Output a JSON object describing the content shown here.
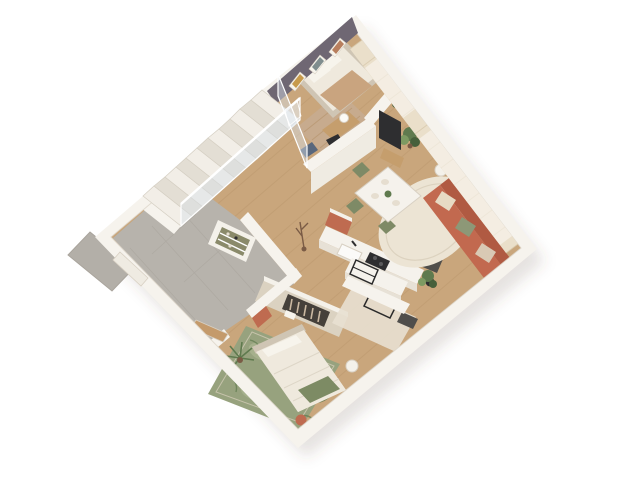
{
  "meta": {
    "description": "Photoreal 3D isometric top-down render of a small duplex apartment floor plan on a plain white background, rotated diamond orientation",
    "canvas": {
      "width": 640,
      "height": 480
    }
  },
  "scene": {
    "type": "3d-floor-plan",
    "view": "isometric top-down, rotated ~40 degrees",
    "floors": {
      "main": "light oak wood",
      "hallway": "grey tile",
      "porch": "grey tile"
    },
    "staircase": {
      "steps": 11,
      "balustrade": "glass",
      "location": "along upper-left exterior wall"
    },
    "rooms": [
      {
        "name": "bedroom-upper",
        "features": [
          "upholstered double bed with white and tan bedding",
          "dark mauve accent wall with three framed artworks",
          "patterned beige rug",
          "navy throw on rug",
          "wooden desk with round white table lamp",
          "black chair",
          "green plant by window",
          "cream curtains"
        ]
      },
      {
        "name": "living-dining",
        "features": [
          "terracotta three-seat sofa with cushions",
          "large round cream rug",
          "white dining table with plates and plant centerpiece",
          "four olive-green chairs",
          "dark TV panel on partition with wooden media console",
          "tall floor plants",
          "sheer white curtains over full-height windows"
        ]
      },
      {
        "name": "kitchen",
        "features": [
          "white counter with sink and black faucet",
          "dark cooktop",
          "terracotta cabinet with white top",
          "black-framed open shelf",
          "island counter",
          "dark floor mat",
          "dark bar stool",
          "branch plant in vase"
        ]
      },
      {
        "name": "nook",
        "features": [
          "black-framed console",
          "small dark mat",
          "light tiled floor"
        ]
      },
      {
        "name": "bedroom-lower",
        "features": [
          "double bed with cream duvet and pillows",
          "green botanical rug",
          "sage green throw",
          "wardrobe with open hanging section and clothes",
          "palm plant",
          "terracotta pouf",
          "round white side table",
          "terracotta accent wall by door",
          "wooden interior door"
        ]
      },
      {
        "name": "hallway-entry",
        "features": [
          "grey tile floor",
          "open shelf unit with olive back panels",
          "staircase with glass balustrade",
          "exterior grey porch pad",
          "entry door"
        ]
      }
    ]
  },
  "colors": {
    "wall": "#f6f3ed",
    "wall_face": "#efebe2",
    "wall_shade": "#e7e1d6",
    "wall_edge": "#dcd5c8",
    "accent": "#6f6773",
    "floor_wood": "#c9a67c",
    "plank": "#b08d62",
    "tile": "#b7b3ac",
    "tile_edge": "#a9a49c",
    "porch": "#b3afa8",
    "curtain": "#eadfca",
    "curtain_fold": "#d8c9ad",
    "sheer": "rgba(250,247,241,0.6)",
    "glass": "rgba(214,224,233,0.45)",
    "white": "#f4f1ea",
    "item_edge": "#d8d0c3",
    "stair_a": "#f2eee7",
    "stair_b": "#e3ded4",
    "stair_edge": "#d5cfc3",
    "sofa": "#c2694f",
    "sofa_back": "#b05a42",
    "cushion_a": "#e7dbc4",
    "cushion_b": "#8d9877",
    "cushion_c": "#d9c9b4",
    "terracotta": "#bf6b50",
    "olive": "#7e8a66",
    "rug_cream": "#ece4d4",
    "rug_cream_edge": "#dcd2bf",
    "rug_pattern": "#c7ab8e",
    "rug_green": "#97a27e",
    "rug_green_hi": "#b2bb98",
    "rug_green_dark": "#6d7b57",
    "bedding": "#efe9dd",
    "bedding_fold": "#dcd4c5",
    "blanket": "#c9a47f",
    "throw": "#7d8b64",
    "headboard": "#cfc5b4",
    "pillow": "#f7f4ec",
    "navy": "#58677d",
    "wood": "#c59e6d",
    "wardrobe": "#dbd2c1",
    "wardrobe_dark": "#45403a",
    "clothes": "#cbb9a2",
    "dark": "#2e2e30",
    "metal": "#2b2b2b",
    "plant": "#5f7a4e",
    "plant_hi": "#7d9a62",
    "plant_dark": "#46603b",
    "pot": "#7a5b45",
    "mat": "#504e4b",
    "table": "#f5f2ec",
    "plate": "#e6ded0",
    "door": "#c49a6b",
    "shelf_olive": "#8a8a6a",
    "sink": "#fbfaf8",
    "nook": "#e8e0d2",
    "lamp": "#fbfaf6",
    "shadow": "rgba(100,82,60,0.16)"
  }
}
